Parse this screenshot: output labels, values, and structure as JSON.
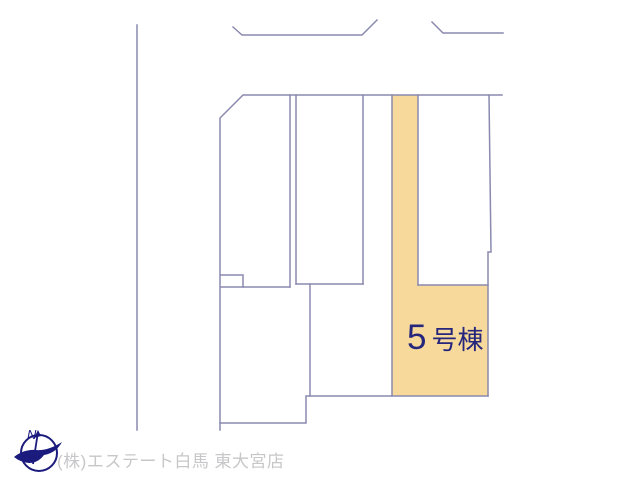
{
  "plan": {
    "highlighted_unit": {
      "number": "5",
      "suffix": "号棟",
      "full_label": "5号棟"
    },
    "highlight_color": "#f7d99b",
    "line_color": "#8a8ab0",
    "label_color": "#26267d"
  },
  "compass": {
    "north_label": "N",
    "color": "#1b1b7e"
  },
  "footer": {
    "company": "(株)エステート白馬 東大宮店",
    "color": "#c7c7c9"
  }
}
